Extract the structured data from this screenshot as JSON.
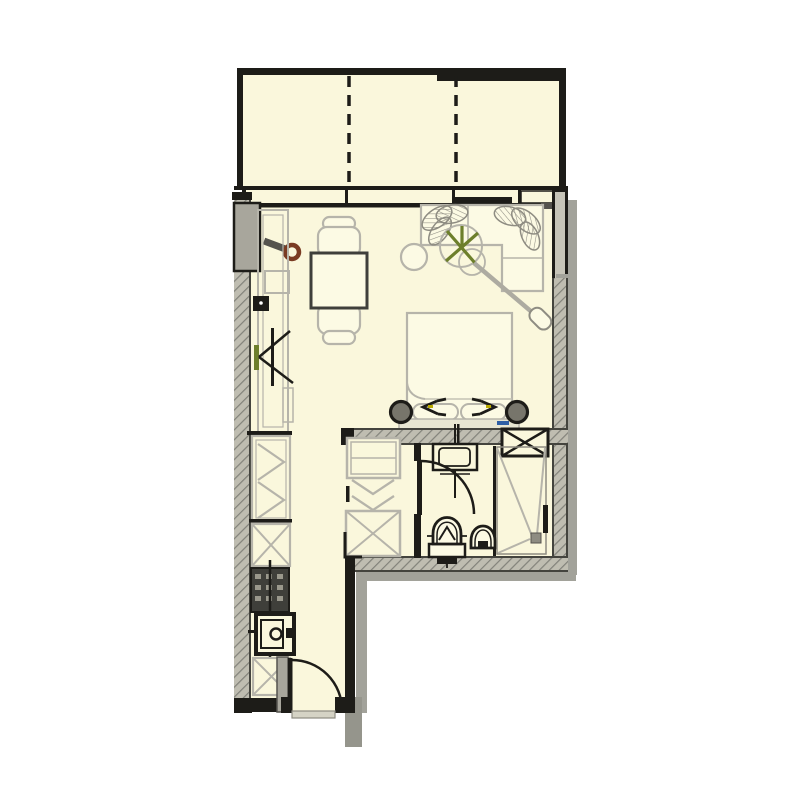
{
  "plan": {
    "kind": "studio-apartment-floor-plan",
    "rooms": [
      "balcony",
      "living-sleeping-area",
      "kitchenette",
      "hallway",
      "bathroom"
    ],
    "symbols": [
      "balcony-partition-dashed",
      "window-band",
      "sliding-glass-door",
      "dining-table",
      "dining-chair-top",
      "dining-chair-bottom",
      "corner-sofa",
      "sofa-cushions",
      "potted-plant",
      "round-side-table",
      "floor-lamp",
      "double-bed",
      "pillow-left",
      "pillow-right",
      "headboard",
      "bedside-sconce-left",
      "bedside-sconce-right",
      "wall-tv",
      "swivel-wall-fixture",
      "kitchen-counter",
      "cooktop",
      "kitchen-sink",
      "appliance-box",
      "wardrobe-left",
      "shelf-unit",
      "wardrobe-appliance-box",
      "washbasin",
      "toilet",
      "bidet",
      "shower",
      "shower-drain",
      "duct-shaft",
      "bathroom-door",
      "entrance-door",
      "outlet-box"
    ]
  },
  "colors": {
    "background": "#FFFFFF",
    "floor": "#FAF7DC",
    "furniture_fill": "#FCFAE4",
    "wall": "#1D1C18",
    "wall_edge": "#44443E",
    "hatch_bg": "#BFBDB1",
    "hatch_line": "#82827A",
    "outline_gray": "#B6B4AA",
    "outline_dark_gray": "#8E8C82",
    "table_border": "#3F3F3B",
    "window_glass": "#C6C4B8",
    "shadow": "#A2A29A",
    "appliance_dark": "#3F3F3A",
    "appliance_knob": "#9A988C",
    "headboard": "#E8E6D2",
    "pier": "#A8A69C",
    "threshold": "#D5D3C5",
    "accent_green": "#6D7F2B",
    "accent_brown": "#7A3B22",
    "accent_blue": "#2E5FA5",
    "accent_yellow": "#B8A800"
  }
}
